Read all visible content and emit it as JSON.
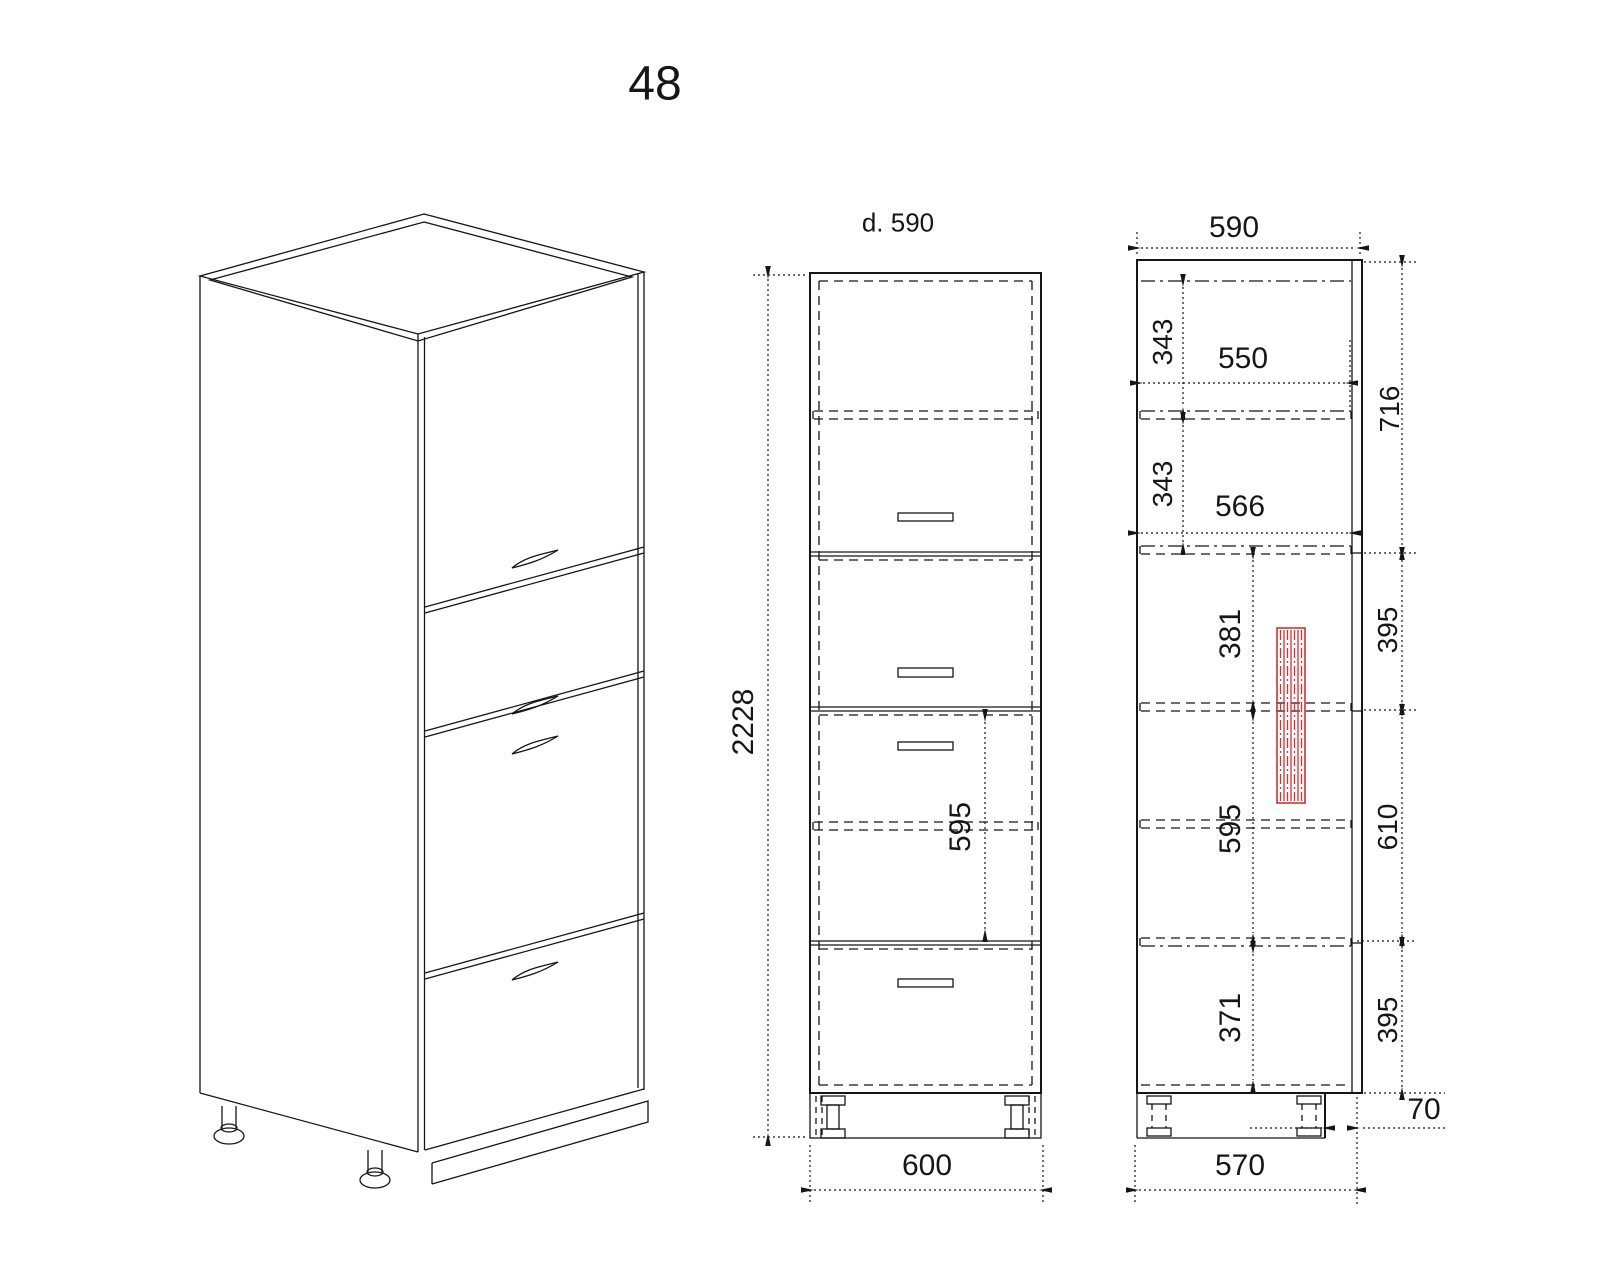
{
  "title": "48",
  "front_view": {
    "depth_note": "d. 590",
    "height": "2228",
    "opening": "595",
    "width": "600"
  },
  "side_view": {
    "depth": "590",
    "gap_top": "343",
    "gap_mid": "343",
    "depth_upper": "550",
    "depth_lower": "566",
    "oven_offset": "381",
    "oven_opening": "595",
    "bottom": "371",
    "col_top": "716",
    "col_upper": "395",
    "col_mid": "610",
    "col_lower": "395",
    "base_depth": "570",
    "plinth_recess": "70"
  },
  "colors": {
    "line": "#161616",
    "accent_red": "#d63030"
  }
}
